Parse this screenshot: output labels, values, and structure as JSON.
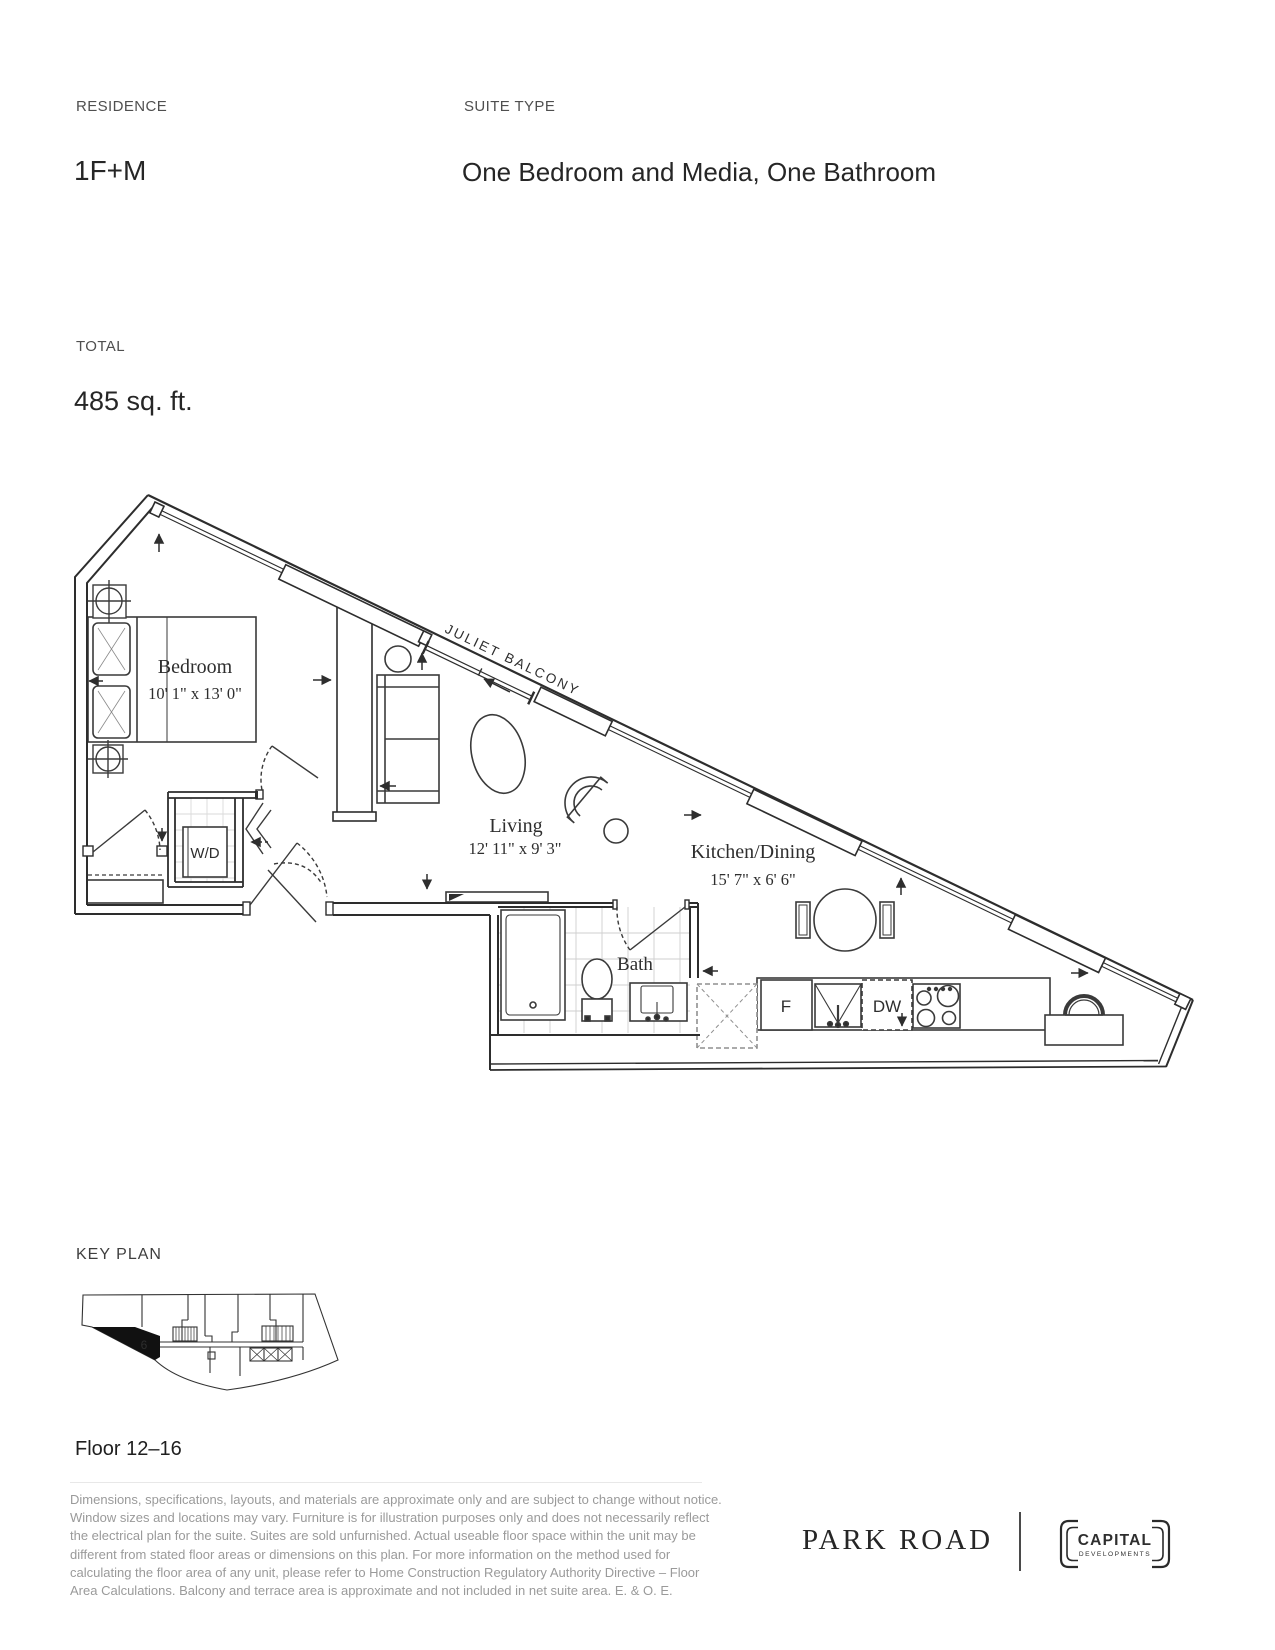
{
  "header": {
    "residence_label": "RESIDENCE",
    "residence_value": "1F+M",
    "suite_type_label": "SUITE TYPE",
    "suite_type_value": "One Bedroom and Media, One Bathroom",
    "total_label": "TOTAL",
    "total_value": "485 sq. ft."
  },
  "floorplan": {
    "balcony_label": "JULIET BALCONY",
    "rooms": [
      {
        "name": "Bedroom",
        "dims": "10' 1\" x 13' 0\""
      },
      {
        "name": "Living",
        "dims": "12' 11\" x 9' 3\""
      },
      {
        "name": "Kitchen/Dining",
        "dims": "15' 7\" x 6' 6\""
      },
      {
        "name": "Bath",
        "dims": ""
      }
    ],
    "labels": {
      "washer_dryer": "W/D",
      "fridge": "F",
      "dishwasher": "DW"
    }
  },
  "key_plan": {
    "label": "KEY PLAN",
    "unit_number": "6",
    "floor_range": "Floor 12–16"
  },
  "disclaimer": "Dimensions, specifications, layouts, and materials are approximate only and are subject to change without notice. Window sizes and locations may vary. Furniture is for illustration purposes only and does not necessarily reflect the electrical plan for the suite. Suites are sold unfurnished. Actual useable floor space within the unit may be different from stated floor areas or dimensions on this plan. For more information on the method used for calculating the floor area of any unit, please refer to Home Construction Regulatory Authority Directive – Floor Area Calculations. Balcony and terrace area is approximate and not included in net suite area. E. & O. E.",
  "footer": {
    "brand": "PARK ROAD",
    "developer_name": "CAPITAL",
    "developer_sub": "DEVELOPMENTS"
  },
  "colors": {
    "line": "#2d2d2d",
    "muted": "#9a9a9a",
    "tile": "#cfcfcf"
  }
}
